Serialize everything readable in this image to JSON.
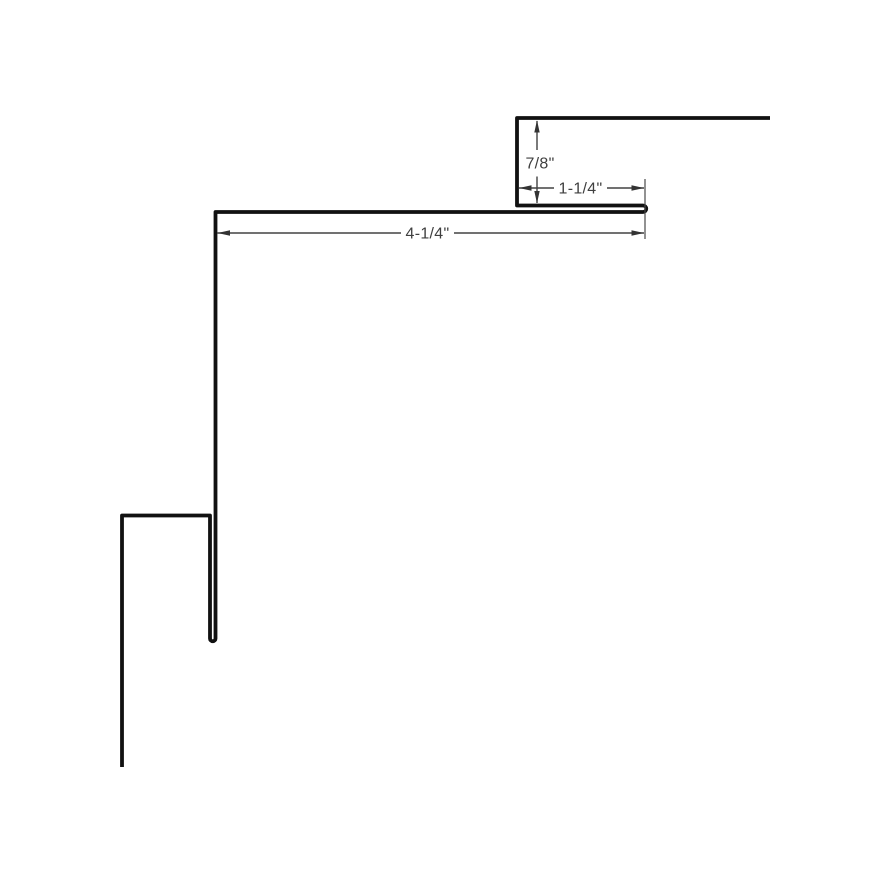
{
  "diagram": {
    "type": "sheet-metal-trim-profile-cross-section",
    "units": "inches",
    "dimensions": {
      "vertical_leg": {
        "label": "7/8\"",
        "value": 0.875,
        "orientation": "vertical"
      },
      "hem_ledge": {
        "label": "1-1/4\"",
        "value": 1.25,
        "orientation": "horizontal"
      },
      "top_flange": {
        "label": "4-1/4\"",
        "value": 4.25,
        "orientation": "horizontal"
      }
    },
    "colors": {
      "background": "#ffffff",
      "profile_line": "#111111",
      "dimension_line": "#424242",
      "dimension_text": "#3f3f3f",
      "arrowhead": "#333333"
    }
  }
}
